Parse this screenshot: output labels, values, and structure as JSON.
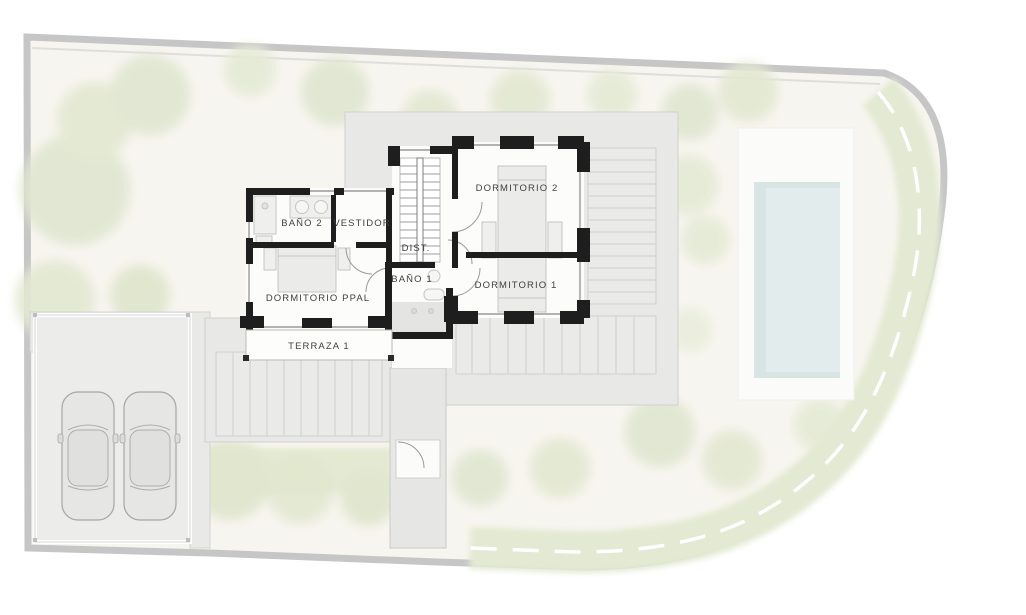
{
  "plan": {
    "kind": "floor-plan-site-plan",
    "rooms": {
      "bano2": "BAÑO 2",
      "vestidor": "VESTIDOR",
      "dormitorio2": "DORMITORIO 2",
      "dist": "DIST.",
      "bano1": "BAÑO 1",
      "dormitorio_ppal": "DORMITORIO PPAL",
      "dormitorio1": "DORMITORIO 1",
      "terraza1": "TERRAZA 1"
    },
    "site": {
      "car_count": 2,
      "colors": {
        "plot_fill": "#f7f5ef",
        "boundary": "#c6c6c6",
        "wall": "#1e1e1e",
        "roof": "#e8e8e6",
        "pool_water": "#dfe9e9",
        "hedge": "#e4ead4",
        "label_text": "#3f3f3f"
      }
    }
  }
}
